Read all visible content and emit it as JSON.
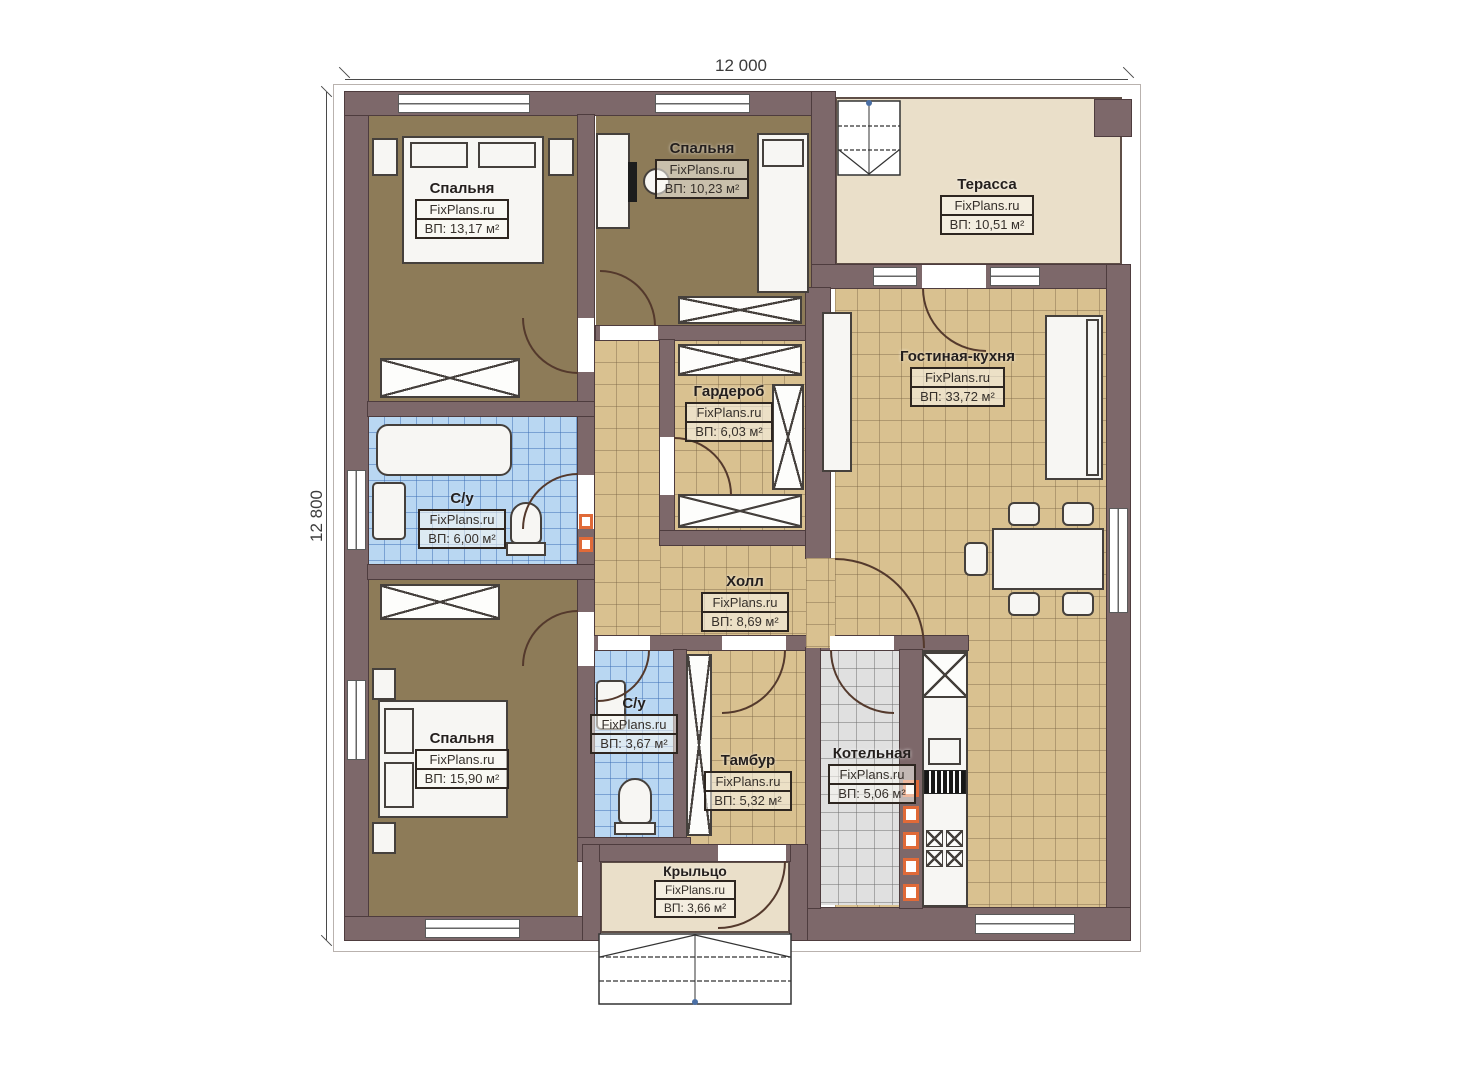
{
  "plan_title": "Floor plan",
  "watermark": "FixPlans.ru",
  "dimensions": {
    "top": "12 000",
    "left": "12 800"
  },
  "rooms": [
    {
      "id": "bedroom-1",
      "name": "Спальня",
      "area": "ВП: 13,17 м²"
    },
    {
      "id": "bedroom-2",
      "name": "Спальня",
      "area": "ВП: 10,23 м²"
    },
    {
      "id": "terrace",
      "name": "Терасса",
      "area": "ВП: 10,51 м²"
    },
    {
      "id": "living-kitchen",
      "name": "Гостиная-кухня",
      "area": "ВП: 33,72 м²"
    },
    {
      "id": "wardrobe",
      "name": "Гардероб",
      "area": "ВП: 6,03 м²"
    },
    {
      "id": "bathroom-1",
      "name": "С/у",
      "area": "ВП: 6,00 м²"
    },
    {
      "id": "hall",
      "name": "Холл",
      "area": "ВП: 8,69 м²"
    },
    {
      "id": "bedroom-3",
      "name": "Спальня",
      "area": "ВП: 15,90 м²"
    },
    {
      "id": "bathroom-2",
      "name": "С/у",
      "area": "ВП: 3,67 м²"
    },
    {
      "id": "tambour",
      "name": "Тамбур",
      "area": "ВП: 5,32 м²"
    },
    {
      "id": "boiler",
      "name": "Котельная",
      "area": "ВП: 5,06 м²"
    },
    {
      "id": "porch",
      "name": "Крыльцо",
      "area": "ВП: 3,66 м²"
    }
  ],
  "colors": {
    "wall": "#7d686a",
    "bedroom_floor": "#8d7b58",
    "tile_floor": "#d9c190",
    "bathroom_tile": "#b9d7f2",
    "boiler_tile": "#e0e0e0",
    "terrace_floor": "#eadfc9",
    "vent_accent": "#e06a38"
  }
}
